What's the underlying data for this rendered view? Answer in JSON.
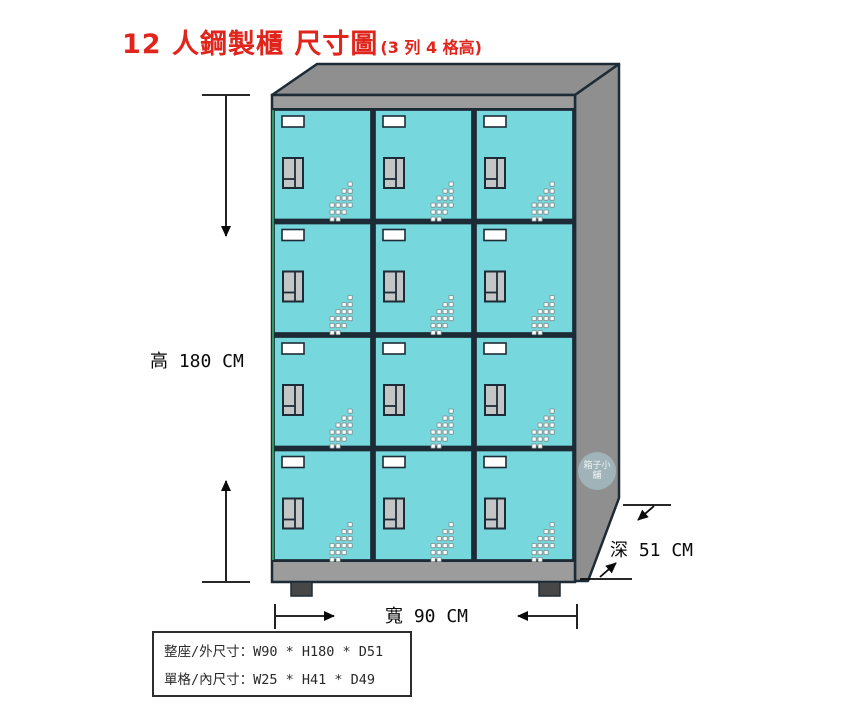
{
  "title": {
    "main": "12 人鋼製櫃 尺寸圖",
    "sub": "(3 列 4 格高)"
  },
  "dimensions": {
    "height": {
      "label": "高 180 CM",
      "value_cm": 180
    },
    "width": {
      "label": "寬 90 CM",
      "value_cm": 90
    },
    "depth": {
      "label": "深 51 CM",
      "value_cm": 51
    }
  },
  "spec_box": {
    "line1": "整座/外尺寸：W90 * H180 * D51",
    "line2": "單格/內尺寸：W25 * H41 * D49"
  },
  "watermark": {
    "text": "箱子小舖"
  },
  "locker": {
    "rows": 4,
    "columns": 3,
    "door_count": 12
  },
  "colors": {
    "door_cyan": "#76d7dd",
    "cabinet_gray": "#8f8f8f",
    "frame_gray": "#9c9c9c",
    "outline_dark": "#1d2b36",
    "foot_dark": "#474747",
    "handle_gray": "#c3c6c6",
    "slot_white": "#ffffff",
    "vent_white": "#ffffff",
    "vent_edge": "#7a8a8a",
    "green_edge": "#2fa36b",
    "title_red": "#e0251c",
    "dimension_black": "#0a0a0a"
  }
}
